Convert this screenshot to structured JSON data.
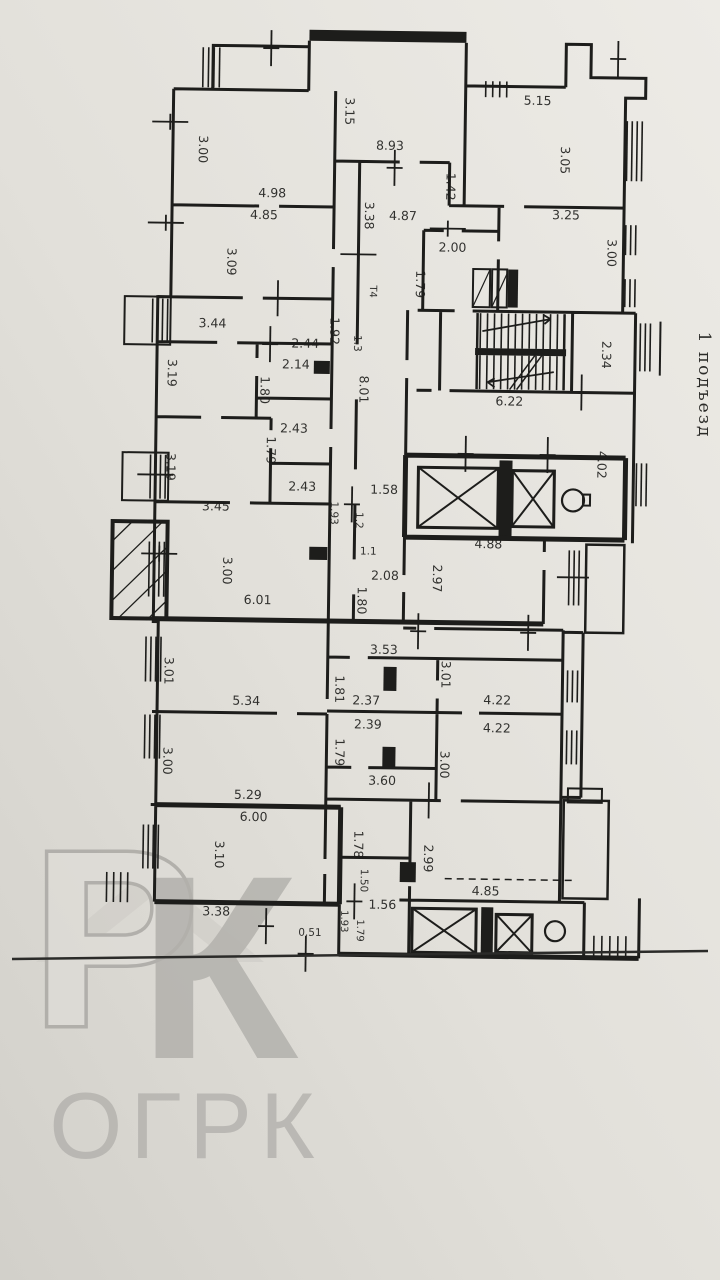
{
  "page": {
    "paper_top": "#edebe6",
    "paper_bottom": "#d5d3cd",
    "ink": "#1d1d1b"
  },
  "watermark": {
    "roof_color": "#cfcdc8",
    "letters": "РК",
    "text": "ОГРК"
  },
  "entrance": {
    "text": "1 подъезд"
  },
  "texts": [
    {
      "name": "dimension-label",
      "text": "3.15",
      "x": 340,
      "y": 112,
      "rot": 90
    },
    {
      "name": "dimension-label",
      "text": "3.00",
      "x": 194,
      "y": 152,
      "rot": 90
    },
    {
      "name": "dimension-label",
      "text": "8.93",
      "x": 385,
      "y": 150,
      "rot": 0
    },
    {
      "name": "dimension-label",
      "text": "5.15",
      "x": 532,
      "y": 103,
      "rot": 0
    },
    {
      "name": "dimension-label",
      "text": "3.05",
      "x": 556,
      "y": 158,
      "rot": 90
    },
    {
      "name": "dimension-label",
      "text": "1.42",
      "x": 442,
      "y": 186,
      "rot": 90
    },
    {
      "name": "dimension-label",
      "text": "4.98",
      "x": 268,
      "y": 199,
      "rot": 0
    },
    {
      "name": "dimension-label",
      "text": "4.85",
      "x": 260,
      "y": 221,
      "rot": 0
    },
    {
      "name": "dimension-label",
      "text": "4.87",
      "x": 399,
      "y": 220,
      "rot": 0
    },
    {
      "name": "dimension-label",
      "text": "3.38",
      "x": 361,
      "y": 216,
      "rot": 90
    },
    {
      "name": "dimension-label",
      "text": "3.25",
      "x": 562,
      "y": 217,
      "rot": 0
    },
    {
      "name": "dimension-label",
      "text": "3.00",
      "x": 604,
      "y": 250,
      "rot": 90
    },
    {
      "name": "dimension-label",
      "text": "2.00",
      "x": 449,
      "y": 251,
      "rot": 0
    },
    {
      "name": "dimension-label",
      "text": "1.79",
      "x": 413,
      "y": 284,
      "rot": 90
    },
    {
      "name": "dimension-label",
      "text": "3.09",
      "x": 224,
      "y": 264,
      "rot": 90
    },
    {
      "name": "vent-label",
      "text": "Т4",
      "x": 367,
      "y": 292,
      "rot": 90,
      "size": 10
    },
    {
      "name": "dimension-label",
      "text": "1.92",
      "x": 328,
      "y": 332,
      "rot": 90
    },
    {
      "name": "dimension-label",
      "text": "3.44",
      "x": 210,
      "y": 330,
      "rot": 0
    },
    {
      "name": "dimension-label",
      "text": "2.44",
      "x": 303,
      "y": 349,
      "rot": 0
    },
    {
      "name": "dimension-label",
      "text": "2.14",
      "x": 294,
      "y": 370,
      "rot": 0
    },
    {
      "name": "dimension-label",
      "text": "1.3",
      "x": 352,
      "y": 344,
      "rot": 90,
      "size": 10.5
    },
    {
      "name": "dimension-label",
      "text": "3.19",
      "x": 166,
      "y": 376,
      "rot": 90
    },
    {
      "name": "dimension-label",
      "text": "1.80",
      "x": 259,
      "y": 392,
      "rot": 90
    },
    {
      "name": "dimension-label",
      "text": "8.01",
      "x": 358,
      "y": 390,
      "rot": 90
    },
    {
      "name": "dimension-label",
      "text": "2.34",
      "x": 600,
      "y": 352,
      "rot": 90
    },
    {
      "name": "dimension-label",
      "text": "6.22",
      "x": 508,
      "y": 404,
      "rot": 0
    },
    {
      "name": "dimension-label",
      "text": "2.43",
      "x": 293,
      "y": 434,
      "rot": 0
    },
    {
      "name": "dimension-label",
      "text": "1.79",
      "x": 266,
      "y": 452,
      "rot": 90
    },
    {
      "name": "dimension-label",
      "text": "3.19",
      "x": 166,
      "y": 470,
      "rot": 90
    },
    {
      "name": "dimension-label",
      "text": "2.43",
      "x": 302,
      "y": 492,
      "rot": 0
    },
    {
      "name": "dimension-label",
      "text": "1.58",
      "x": 384,
      "y": 494,
      "rot": 0
    },
    {
      "name": "dimension-label",
      "text": "1.93",
      "x": 331,
      "y": 514,
      "rot": 90,
      "size": 10.5
    },
    {
      "name": "dimension-label",
      "text": "1.2",
      "x": 356,
      "y": 521,
      "rot": 90,
      "size": 10.5
    },
    {
      "name": "dimension-label",
      "text": "4.02",
      "x": 597,
      "y": 462,
      "rot": 90
    },
    {
      "name": "dimension-label",
      "text": "3.45",
      "x": 216,
      "y": 513,
      "rot": 0
    },
    {
      "name": "dimension-label",
      "text": "4.88",
      "x": 489,
      "y": 547,
      "rot": 0
    },
    {
      "name": "dimension-label",
      "text": "1.1",
      "x": 369,
      "y": 555,
      "rot": 0,
      "size": 10.5
    },
    {
      "name": "dimension-label",
      "text": "2.97",
      "x": 434,
      "y": 578,
      "rot": 90
    },
    {
      "name": "dimension-label",
      "text": "3.00",
      "x": 224,
      "y": 573,
      "rot": 90
    },
    {
      "name": "dimension-label",
      "text": "2.08",
      "x": 386,
      "y": 580,
      "rot": 0
    },
    {
      "name": "dimension-label",
      "text": "1.80",
      "x": 359,
      "y": 601,
      "rot": 90
    },
    {
      "name": "dimension-label",
      "text": "6.01",
      "x": 259,
      "y": 606,
      "rot": 0
    },
    {
      "name": "dimension-label",
      "text": "3.01",
      "x": 167,
      "y": 674,
      "rot": 90
    },
    {
      "name": "dimension-label",
      "text": "3.53",
      "x": 386,
      "y": 654,
      "rot": 0
    },
    {
      "name": "dimension-label",
      "text": "1.81",
      "x": 338,
      "y": 690,
      "rot": 90
    },
    {
      "name": "dimension-label",
      "text": "2.37",
      "x": 369,
      "y": 705,
      "rot": 0
    },
    {
      "name": "dimension-label",
      "text": "3.01",
      "x": 444,
      "y": 674,
      "rot": 90
    },
    {
      "name": "dimension-label",
      "text": "4.22",
      "x": 500,
      "y": 703,
      "rot": 0
    },
    {
      "name": "dimension-label",
      "text": "5.34",
      "x": 249,
      "y": 707,
      "rot": 0
    },
    {
      "name": "dimension-label",
      "text": "2.39",
      "x": 371,
      "y": 729,
      "rot": 0
    },
    {
      "name": "dimension-label",
      "text": "4.22",
      "x": 500,
      "y": 731,
      "rot": 0
    },
    {
      "name": "dimension-label",
      "text": "1.79",
      "x": 339,
      "y": 753,
      "rot": 90
    },
    {
      "name": "dimension-label",
      "text": "3.00",
      "x": 167,
      "y": 764,
      "rot": 90
    },
    {
      "name": "dimension-label",
      "text": "3.00",
      "x": 444,
      "y": 764,
      "rot": 90
    },
    {
      "name": "dimension-label",
      "text": "3.60",
      "x": 386,
      "y": 785,
      "rot": 0
    },
    {
      "name": "dimension-label",
      "text": "5.29",
      "x": 252,
      "y": 801,
      "rot": 0
    },
    {
      "name": "dimension-label",
      "text": "6.00",
      "x": 258,
      "y": 823,
      "rot": 0
    },
    {
      "name": "dimension-label",
      "text": "3.10",
      "x": 220,
      "y": 857,
      "rot": 90
    },
    {
      "name": "dimension-label",
      "text": "1.78",
      "x": 359,
      "y": 845,
      "rot": 90
    },
    {
      "name": "dimension-label",
      "text": "2.99",
      "x": 429,
      "y": 858,
      "rot": 90
    },
    {
      "name": "dimension-label",
      "text": "1.50",
      "x": 366,
      "y": 881,
      "rot": 90,
      "size": 10.5
    },
    {
      "name": "dimension-label",
      "text": "1.56",
      "x": 388,
      "y": 909,
      "rot": 0
    },
    {
      "name": "dimension-label",
      "text": "4.85",
      "x": 491,
      "y": 894,
      "rot": 0
    },
    {
      "name": "dimension-label",
      "text": "1.93",
      "x": 347,
      "y": 922,
      "rot": 90,
      "size": 10
    },
    {
      "name": "dimension-label",
      "text": "1.79",
      "x": 363,
      "y": 931,
      "rot": 90,
      "size": 10
    },
    {
      "name": "dimension-label",
      "text": "0.51",
      "x": 316,
      "y": 937,
      "rot": 0,
      "size": 10.5
    },
    {
      "name": "dimension-label",
      "text": "3.38",
      "x": 222,
      "y": 918,
      "rot": 0
    },
    {
      "name": "entrance-label",
      "text": "1 подъезд",
      "x": 699,
      "y": 385,
      "rot": 90,
      "size": 17,
      "spacing": 2,
      "fill": "#2b2b28",
      "layer": "overlay-layer",
      "font": "\"DejaVu Serif\", serif"
    },
    {
      "name": "watermark-letter-p",
      "text": "Р",
      "x": 115,
      "y": 1025,
      "rot": 0,
      "size": 250,
      "fill": "#dedcd7",
      "stroke": "#a8a6a2",
      "strokeWidth": 7,
      "bold": true,
      "layer": "watermark-layer",
      "font": "\"Liberation Sans\", sans-serif"
    },
    {
      "name": "watermark-letter-k",
      "text": "К",
      "x": 218,
      "y": 1058,
      "rot": 0,
      "size": 262,
      "fill": "#a9a7a3",
      "bold": true,
      "opacity": 0.85,
      "layer": "watermark-layer",
      "font": "\"Liberation Sans\", sans-serif"
    },
    {
      "name": "watermark-text",
      "text": "ОГРК",
      "x": 186,
      "y": 1158,
      "rot": 0,
      "size": 94,
      "fill": "#b3b1ad",
      "spacing": 8,
      "layer": "watermark-layer",
      "font": "\"Liberation Sans\", sans-serif"
    }
  ]
}
